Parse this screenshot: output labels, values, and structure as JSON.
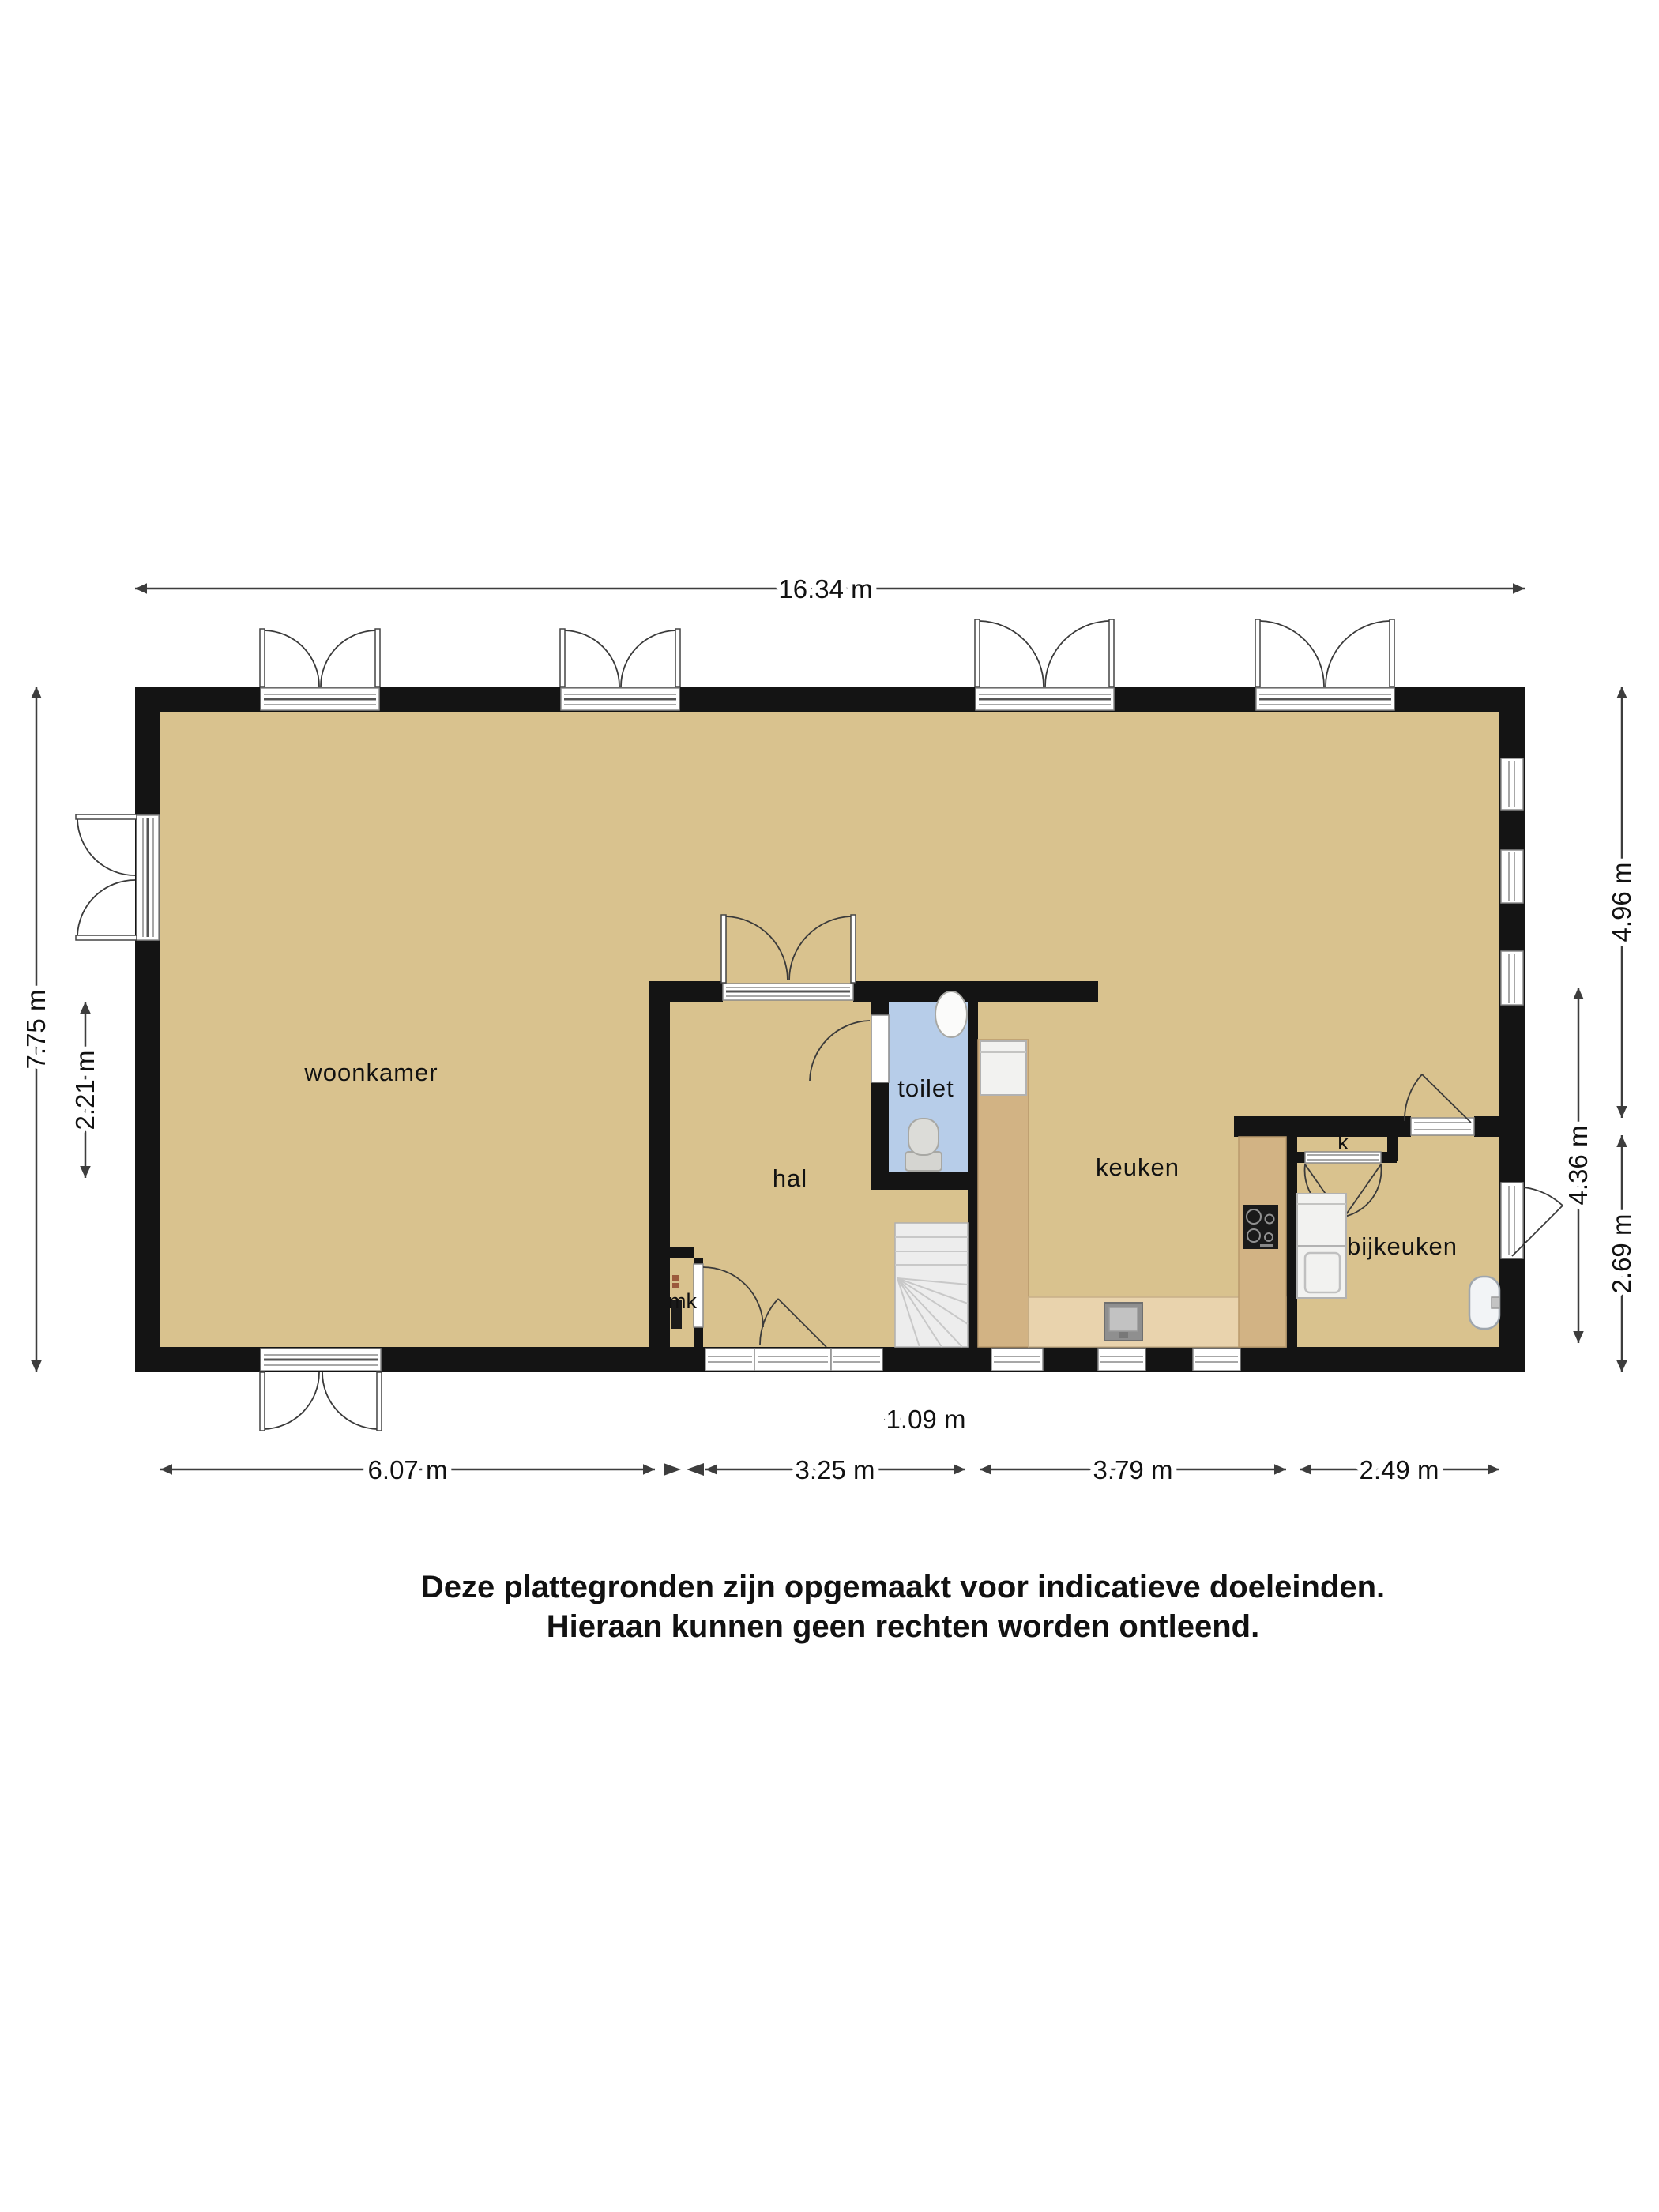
{
  "colors": {
    "floor": "#d9c28e",
    "wall": "#141414",
    "toilet_floor": "#b7cde9",
    "wood": "#d2b384",
    "wood_light": "#e9d3ad",
    "stair": "#ededed",
    "appliance": "#f2f2f0",
    "fixture": "#d5d5d1",
    "dim_line": "#3d3d3d",
    "label": "#111111"
  },
  "rooms": {
    "woonkamer": "woonkamer",
    "hal": "hal",
    "toilet": "toilet",
    "keuken": "keuken",
    "bijkeuken": "bijkeuken",
    "meter_closet": "mk",
    "closet": "k"
  },
  "dimensions": {
    "total_width": "16.34 m",
    "total_height": "7.75 m",
    "left_partial": "2.21 m",
    "right_top": "4.96 m",
    "right_middle": "4.36 m",
    "right_bottom": "2.69 m",
    "bottom_woonkamer": "6.07 m",
    "bottom_hal": "3.25 m",
    "bottom_keuken": "3.79 m",
    "bottom_bijkeuken": "2.49 m",
    "stair_width": "1.09 m"
  },
  "disclaimer": {
    "line1": "Deze plattegronden zijn opgemaakt voor indicatieve doeleinden.",
    "line2": "Hieraan kunnen geen rechten worden ontleend."
  }
}
